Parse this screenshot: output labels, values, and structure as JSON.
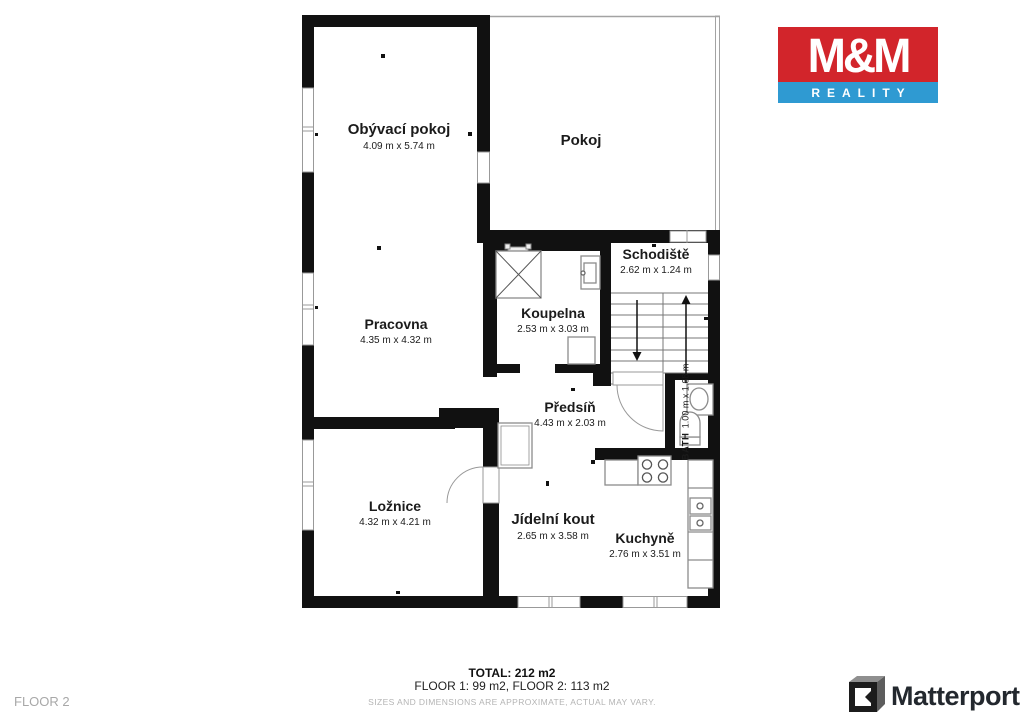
{
  "branding": {
    "mm_logo": {
      "line1": "M&M",
      "line2": "REALITY",
      "red": "#d2252b",
      "blue": "#2f9ad2"
    },
    "matterport": {
      "label": "Matterport"
    }
  },
  "floor_plan": {
    "rooms": [
      {
        "id": "obyvaci-pokoj",
        "name": "Obývací pokoj",
        "dims": "4.09 m x 5.74 m"
      },
      {
        "id": "pokoj",
        "name": "Pokoj",
        "dims": ""
      },
      {
        "id": "schodiste",
        "name": "Schodiště",
        "dims": "2.62 m x 1.24 m"
      },
      {
        "id": "koupelna",
        "name": "Koupelna",
        "dims": "2.53 m x 3.03 m"
      },
      {
        "id": "pracovna",
        "name": "Pracovna",
        "dims": "4.35 m x 4.32 m"
      },
      {
        "id": "predsin",
        "name": "Předsíň",
        "dims": "4.43 m x 2.03 m"
      },
      {
        "id": "bath",
        "name": "BATH",
        "dims": "1.00 m x 1.68 m"
      },
      {
        "id": "loznice",
        "name": "Ložnice",
        "dims": "4.32 m x 4.21 m"
      },
      {
        "id": "jidelni-kout",
        "name": "Jídelní kout",
        "dims": "2.65 m x 3.58 m"
      },
      {
        "id": "kuchyne",
        "name": "Kuchyně",
        "dims": "2.76 m x 3.51 m"
      }
    ],
    "wall_color": "#111111"
  },
  "footer": {
    "floor_label": "FLOOR 2",
    "total": "TOTAL: 212 m2",
    "floors": "FLOOR 1: 99 m2, FLOOR 2: 113 m2",
    "disclaimer": "SIZES AND DIMENSIONS ARE APPROXIMATE, ACTUAL MAY VARY."
  }
}
